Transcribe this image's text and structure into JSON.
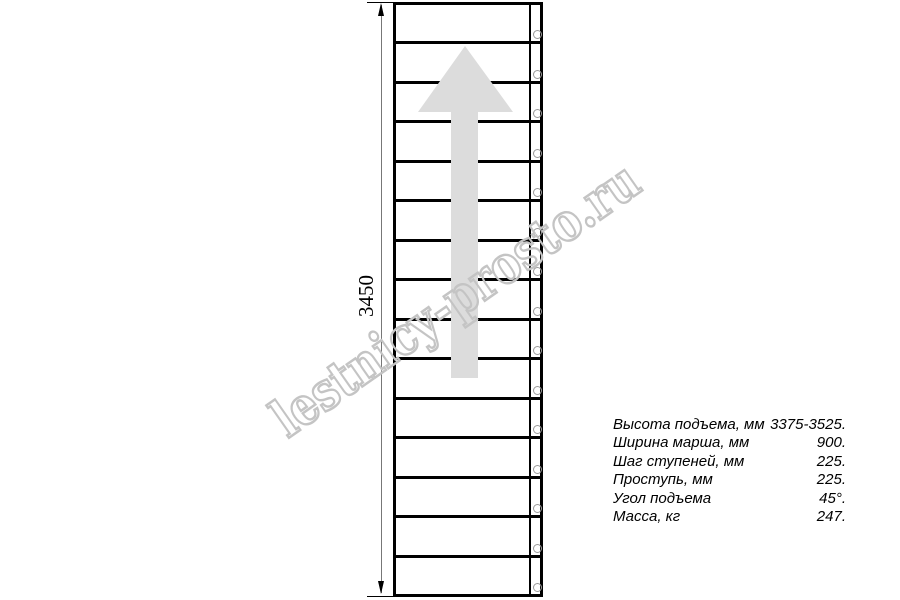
{
  "drawing": {
    "type": "staircase-plan-top-view",
    "dimension_label": "3450",
    "tread_count": 15,
    "direction_arrow": "up",
    "colors": {
      "outline": "#000000",
      "direction_arrow": "#dcdcdc",
      "fastener_circle": "#9a9a9a",
      "dimension_line": "#777777",
      "watermark": "#c4c4c4"
    }
  },
  "watermark": {
    "text": "lestnicy-prosto.ru"
  },
  "specs": {
    "rows": [
      {
        "label": "Высота подъема, мм",
        "value": "3375-3525."
      },
      {
        "label": "Ширина марша, мм",
        "value": "900."
      },
      {
        "label": "Шаг ступеней, мм",
        "value": "225."
      },
      {
        "label": "Проступь, мм",
        "value": "225."
      },
      {
        "label": "Угол подъема",
        "value": "45°."
      },
      {
        "label": "Масса, кг",
        "value": "247."
      }
    ]
  }
}
